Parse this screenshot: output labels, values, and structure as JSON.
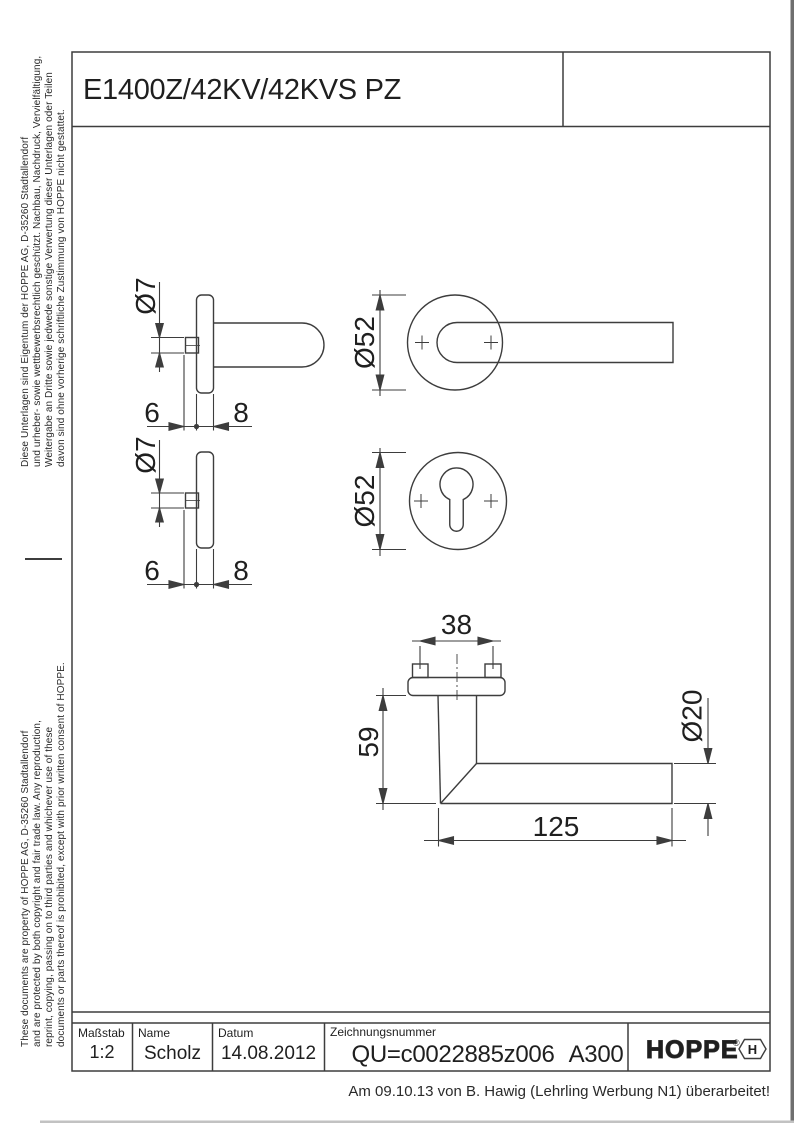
{
  "title_block_top": {
    "title": "E1400Z/42KV/42KVS PZ"
  },
  "legal": {
    "german_lines": [
      "Diese Unterlagen sind Eigentum der  HOPPE AG, D-35260 Stadtallendorf",
      "und urheber- sowie wettbewerbsrechtlich geschützt. Nachbau, Nachdruck, Vervielfältigung,",
      "Weitergabe an Dritte sowie jedwede sonstige Verwertung dieser Unterlagen oder Teilen",
      "davon sind ohne vorherige schriftliche Zustimmung von HOPPE nicht gestattet."
    ],
    "english_lines": [
      "These documents are property of HOPPE AG, D-35260 Stadtallendorf",
      "and are protected by both copyright and fair trade law. Any reproduction,",
      "reprint, copying, passing on to third parties and whichever use of these",
      "documents or parts thereof is prohibited, except with prior written consent of HOPPE."
    ]
  },
  "views": {
    "handle_side": {
      "dia": "Ø7",
      "d6": "6",
      "d8": "8"
    },
    "handle_front": {
      "dia": "Ø52"
    },
    "key_side": {
      "dia": "Ø7",
      "d6": "6",
      "d8": "8"
    },
    "key_front": {
      "dia": "Ø52"
    },
    "plan": {
      "screw_distance": "38",
      "neck_height": "59",
      "grip_dia": "Ø20",
      "grip_length": "125"
    }
  },
  "title_block_bottom": {
    "scale_label": "Maßstab",
    "scale_value": "1:2",
    "name_label": "Name",
    "name_value": "Scholz",
    "date_label": "Datum",
    "date_value": "14.08.2012",
    "number_label": "Zeichnungsnummer",
    "number_value": "QU=c0022885z006",
    "revision": "A300",
    "logo_text": "HOPPE",
    "logo_reg": "®",
    "logo_symbol_letter": "H"
  },
  "footer": {
    "note": "Am 09.10.13 von B. Hawig (Lehrling Werbung N1) überarbeitet!"
  },
  "colors": {
    "line": "#3d3d3d",
    "text": "#1f1f1f",
    "edge_strip": "#6f6f6f"
  }
}
